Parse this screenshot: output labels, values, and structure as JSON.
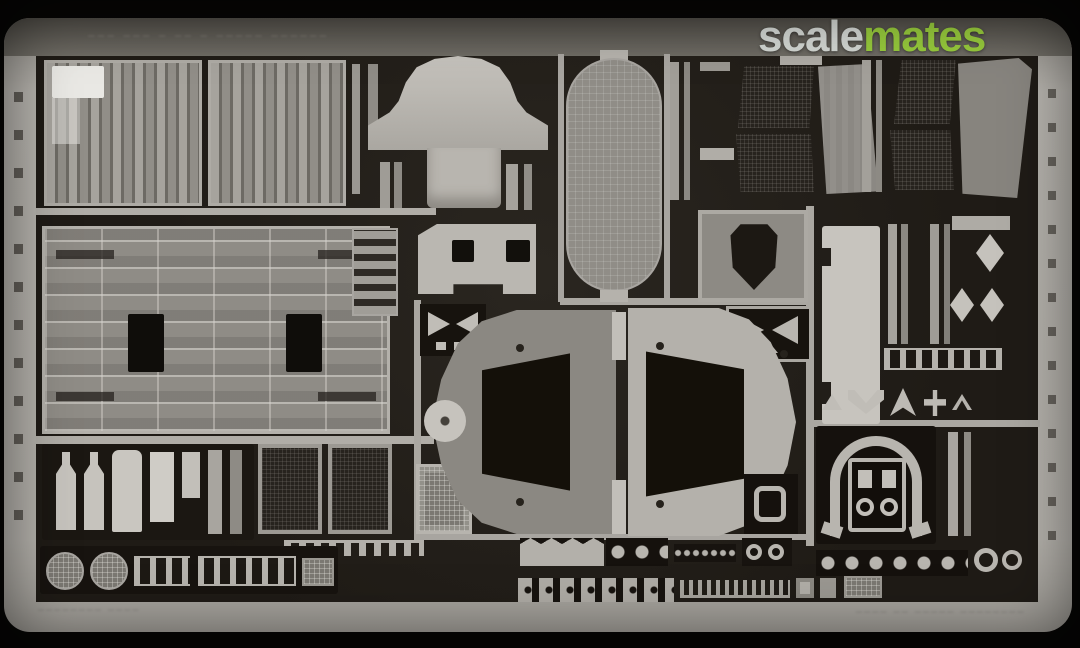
{
  "image": {
    "subject": "photo-etched metal detail fret for a scale model kit (product photo)",
    "background_color": "#070605",
    "fret_metal_color": "#b3b0aa",
    "etched_dark_color": "#221e19"
  },
  "watermark": {
    "text": "scalemates",
    "part_gray": "scale",
    "part_green": "mates",
    "gray_color": "#d2d6d2",
    "green_color": "#96c93c"
  },
  "etched_markings": {
    "top_label_illegible": "––– –––  – ––  – –––––  ––––––",
    "bottom_left_illegible": "––––––––  ––––",
    "bottom_right_illegible": "––––  ––  –––––  ––––––––"
  },
  "parts_inventory": [
    "two louvered grille panels",
    "large gridded engine-deck panel with two rectangular openings",
    "bell/dome shaped cover",
    "perforated capsule-shaped screen",
    "dark mesh trapezoid panels (two pairs)",
    "shield-shaped plate in frame",
    "two fan-shroud halves with trapezoid cutouts",
    "horseshoe/arch bracket with framed inner parts",
    "mesh discs, ladders, diamonds, chains of small fittings"
  ]
}
